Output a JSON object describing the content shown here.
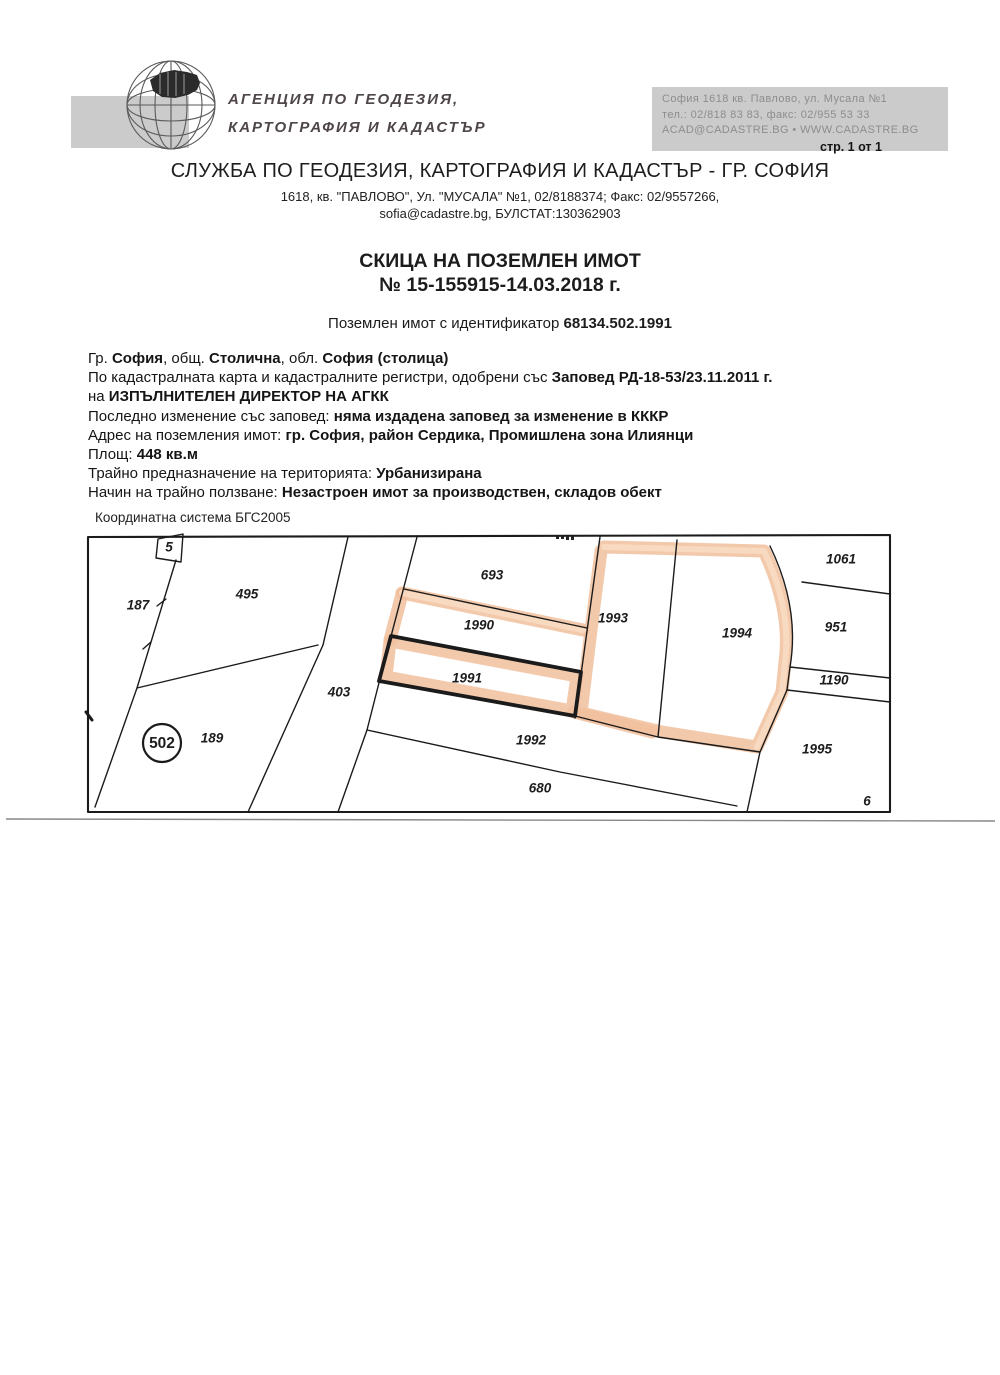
{
  "page": {
    "page_label": "стр. 1 от 1"
  },
  "logo": {
    "icon": "globe-wireframe-with-bulgaria-map",
    "line1": "АГЕНЦИЯ ПО ГЕОДЕЗИЯ,",
    "line2": "КАРТОГРАФИЯ И КАДАСТЪР"
  },
  "agency_contact": [
    "София 1618  кв. Павлово, ул. Мусала №1",
    "тел.: 02/818 83 83, факс: 02/955 53 33",
    "ACAD@CADASTRE.BG  •  WWW.CADASTRE.BG"
  ],
  "office": {
    "title": "СЛУЖБА ПО ГЕОДЕЗИЯ, КАРТОГРАФИЯ И КАДАСТЪР - ГР. СОФИЯ",
    "address1": "1618, кв. \"ПАВЛОВО\", Ул. \"МУСАЛА\" №1, 02/8188374; Факс: 02/9557266,",
    "address2": "sofia@cadastre.bg, БУЛСТАТ:130362903"
  },
  "document": {
    "title": "СКИЦА НА ПОЗЕМЛЕН ИМОТ",
    "number": "№ 15-155915-14.03.2018 г.",
    "id_prefix": "Поземлен имот с  идентификатор  ",
    "id_value": "68134.502.1991"
  },
  "details": [
    [
      {
        "t": "Гр. "
      },
      {
        "t": "София",
        "b": 1
      },
      {
        "t": ", общ. "
      },
      {
        "t": "Столична",
        "b": 1
      },
      {
        "t": ", обл. "
      },
      {
        "t": "София (столица)",
        "b": 1
      }
    ],
    [
      {
        "t": "По кадастралната карта и кадастралните регистри, одобрени със "
      },
      {
        "t": "Заповед РД-18-53/23.11.2011 г.",
        "b": 1
      }
    ],
    [
      {
        "t": "на "
      },
      {
        "t": "ИЗПЪЛНИТЕЛЕН ДИРЕКТОР НА АГКК",
        "b": 1
      }
    ],
    [
      {
        "t": "Последно изменение със заповед: "
      },
      {
        "t": "няма издадена заповед за изменение в КККР",
        "b": 1
      }
    ],
    [
      {
        "t": "Адрес на поземления имот: "
      },
      {
        "t": "гр. София, район Сердика, Промишлена зона Илиянци",
        "b": 1
      }
    ],
    [
      {
        "t": "Площ: "
      },
      {
        "t": "448 кв.м",
        "b": 1
      }
    ],
    [
      {
        "t": "Трайно предназначение на територията: "
      },
      {
        "t": "Урбанизирана",
        "b": 1
      }
    ],
    [
      {
        "t": "Начин на трайно ползване: "
      },
      {
        "t": "Незастроен имот за производствен, складов обект",
        "b": 1
      }
    ]
  ],
  "map": {
    "coord_system": "Координатна система БГС2005",
    "subject_parcel": "1991",
    "highlight_color": "#f1c09e",
    "district": {
      "number": "502",
      "x": 162,
      "y": 744
    },
    "parcels": [
      {
        "n": "5",
        "x": 169,
        "y": 548,
        "s": 11
      },
      {
        "n": "187",
        "x": 138,
        "y": 606
      },
      {
        "n": "495",
        "x": 247,
        "y": 595
      },
      {
        "n": "693",
        "x": 492,
        "y": 576
      },
      {
        "n": "1990",
        "x": 479,
        "y": 626
      },
      {
        "n": "1991",
        "x": 467,
        "y": 679
      },
      {
        "n": "403",
        "x": 339,
        "y": 693
      },
      {
        "n": "189",
        "x": 212,
        "y": 739
      },
      {
        "n": "1992",
        "x": 531,
        "y": 741
      },
      {
        "n": "680",
        "x": 540,
        "y": 789
      },
      {
        "n": "1993",
        "x": 613,
        "y": 619
      },
      {
        "n": "1994",
        "x": 737,
        "y": 634
      },
      {
        "n": "1061",
        "x": 841,
        "y": 560
      },
      {
        "n": "951",
        "x": 836,
        "y": 628
      },
      {
        "n": "1190",
        "x": 834,
        "y": 681
      },
      {
        "n": "1995",
        "x": 817,
        "y": 750
      },
      {
        "n": "6",
        "x": 867,
        "y": 802,
        "s": 12
      }
    ]
  }
}
